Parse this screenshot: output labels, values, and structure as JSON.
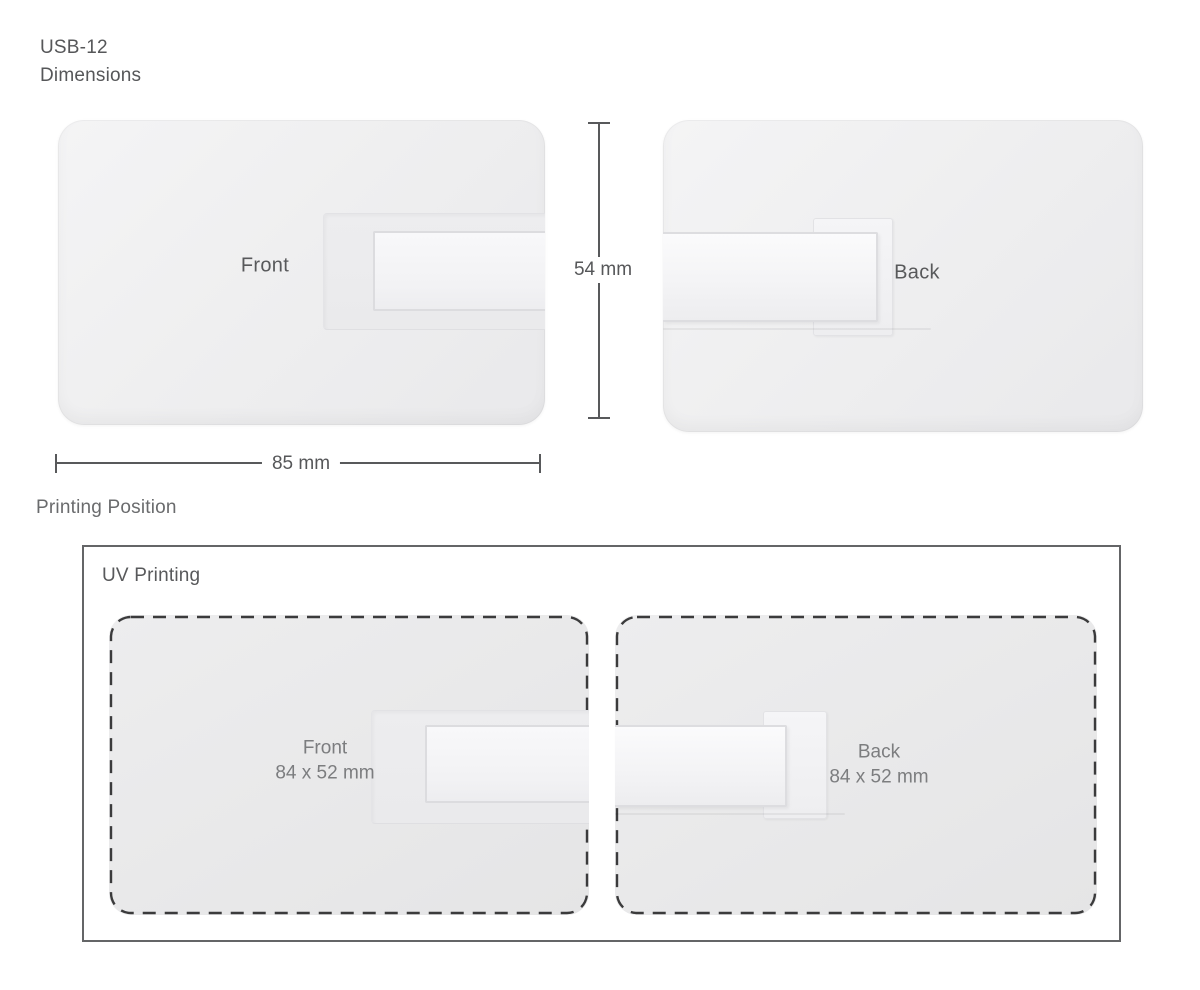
{
  "header": {
    "model": "USB-12",
    "section": "Dimensions"
  },
  "dimensions_view": {
    "front_card_label": "Front",
    "back_card_label": "Back",
    "height_dimension": "54 mm",
    "width_dimension": "85 mm"
  },
  "printing": {
    "heading": "Printing Position",
    "method_label": "UV Printing",
    "front_card": {
      "label": "Front",
      "size": "84 x 52 mm"
    },
    "back_card": {
      "label": "Back",
      "size": "84 x 52 mm"
    }
  },
  "colors": {
    "text_primary": "#58595b",
    "text_secondary": "#7c7d7f",
    "dimension_line": "#58595b",
    "dashed_outline": "#3b3b3c",
    "print_box_border": "#646567",
    "card_fill_light": "#f2f2f3",
    "card_fill_print": "#e8e8e9",
    "background": "#ffffff"
  }
}
